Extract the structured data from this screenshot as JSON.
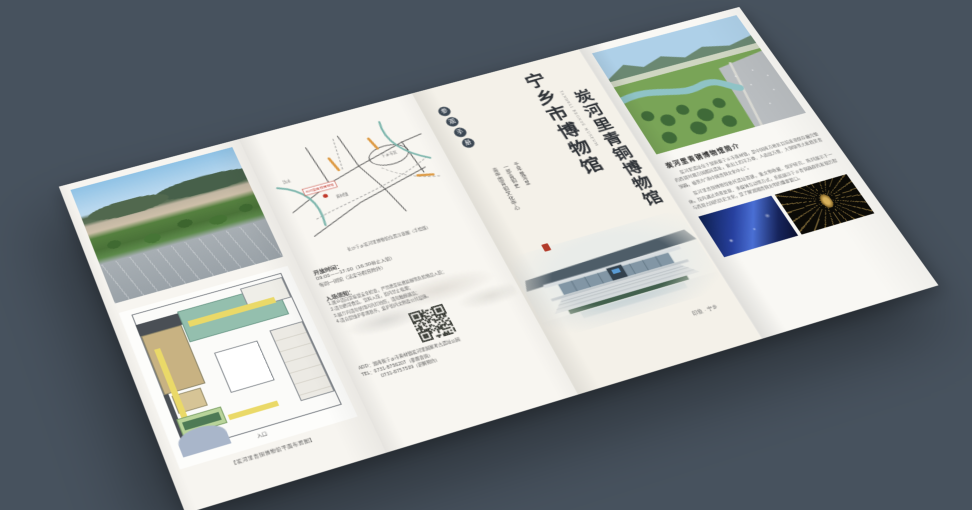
{
  "canvas": {
    "background": "#47525e"
  },
  "colors": {
    "paper": "#f6f4ee",
    "seal_red": "#b23b2a",
    "map_pin_red": "#c0392b",
    "river_teal": "#7fb7ae",
    "plan_tan": "#c8b282",
    "plan_teal": "#94bfae",
    "plan_yellow": "#ead968",
    "badge_dark": "#3c4854"
  },
  "brochure": {
    "left_panel": {
      "photo": "aerial-city-park-photo",
      "plan_caption": "【炭河里青铜博物馆平面布置图】",
      "plan_entrance_label": "入口"
    },
    "map_panel": {
      "pin_label": "炭河里青铜博物馆",
      "labels": {
        "town": "黄材镇",
        "city": "宁乡市区",
        "river": "沩水"
      },
      "caption": "长沙宁乡炭河里博物馆位置示意图（手绘版）",
      "hours_title": "开放时间：",
      "hours_line1": "09:00——17:00（16:30停止入馆）",
      "hours_line2": "每周一闭馆（法定节假日除外）",
      "notice_title": "入场须知：",
      "notice_lines": [
        "1.观众请自觉接受安全检查，严禁携带易燃易爆等危险物品入馆；",
        "2.请勿携带食品、饮料入馆，馆内禁止吸烟；",
        "3.展厅内请勿使用闪光灯拍照，请勿触摸展品；",
        "4.请自觉维护参观秩序，爱护馆内文物及公共设施。"
      ],
      "address": "ADD：湖南省宁乡市黄材镇炭河里国家考古遗址公园",
      "tel_line1": "TEL：0731-8756207（参观咨询）",
      "tel_line2": "0731-8757509（讲解预约）"
    },
    "title_panel": {
      "badge_chars": [
        "参",
        "观",
        "手",
        "册"
      ],
      "main_title": "宁乡市博物馆",
      "sub_title": "炭河里青铜博物馆",
      "pinyin": "TANHELI BRONZE MUSEUM",
      "poem_lines": [
        "千年炭河里",
        "一部青铜史",
        "南中国青铜文化中心"
      ],
      "photo_caption": "印象 · 宁乡"
    },
    "intro_panel": {
      "title": "炭河里青铜博物馆简介",
      "para1": "炭河里遗址位于湖南省宁乡市黄材镇，是中国南方地区目前发现保存最完整的西周时期方国都邑遗址，曾出土四羊方尊、人面纹方鼎、大铜铙等大批精美青铜器，被誉为“南中国青铜文化中心”。",
      "para2": "炭河里青铜博物馆依托遗址而建，集文物收藏、保护研究、陈列展示于一体。馆内通过场景复原、多媒体互动等方式，系统展示宁乡青铜器群的发现历程与西周古国的历史文化，是了解湖湘青铜文明的重要窗口。"
    }
  }
}
